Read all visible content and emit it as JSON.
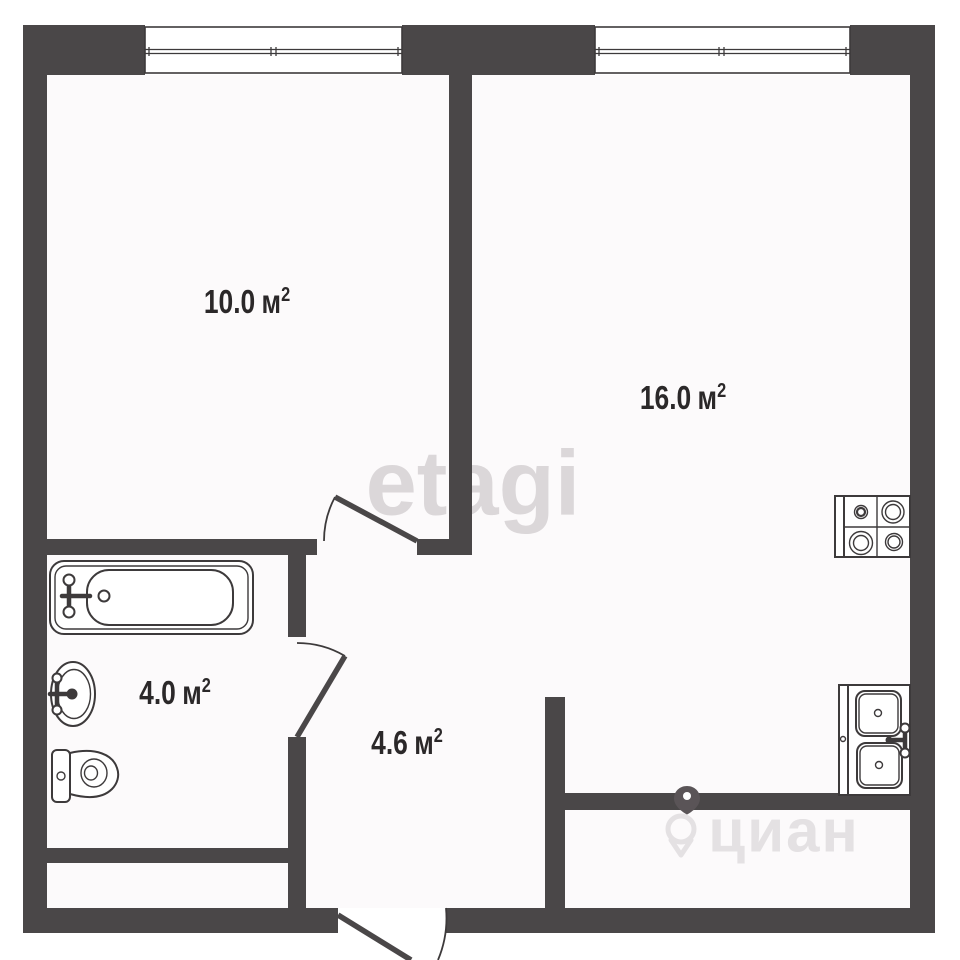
{
  "floorplan": {
    "rooms": [
      {
        "id": "room-top-left",
        "area": "10.0",
        "unit": "м",
        "sup": "2"
      },
      {
        "id": "room-top-right",
        "area": "16.0",
        "unit": "м",
        "sup": "2"
      },
      {
        "id": "bathroom",
        "area": "4.0",
        "unit": "м",
        "sup": "2"
      },
      {
        "id": "hallway",
        "area": "4.6",
        "unit": "м",
        "sup": "2"
      }
    ],
    "fixtures": [
      "bathtub",
      "washbasin",
      "toilet",
      "stove",
      "kitchen-sink"
    ],
    "windows_count": 2,
    "watermarks": {
      "etagi": "etagi",
      "cian": "циан"
    },
    "colors": {
      "wall": "#4a4748",
      "line": "#3d3a3b",
      "label_text": "#2b2829",
      "watermark_etagi": "#dbd7d9",
      "watermark_cian": "#e4e1e3",
      "room_fill": "#fcfafb"
    }
  }
}
